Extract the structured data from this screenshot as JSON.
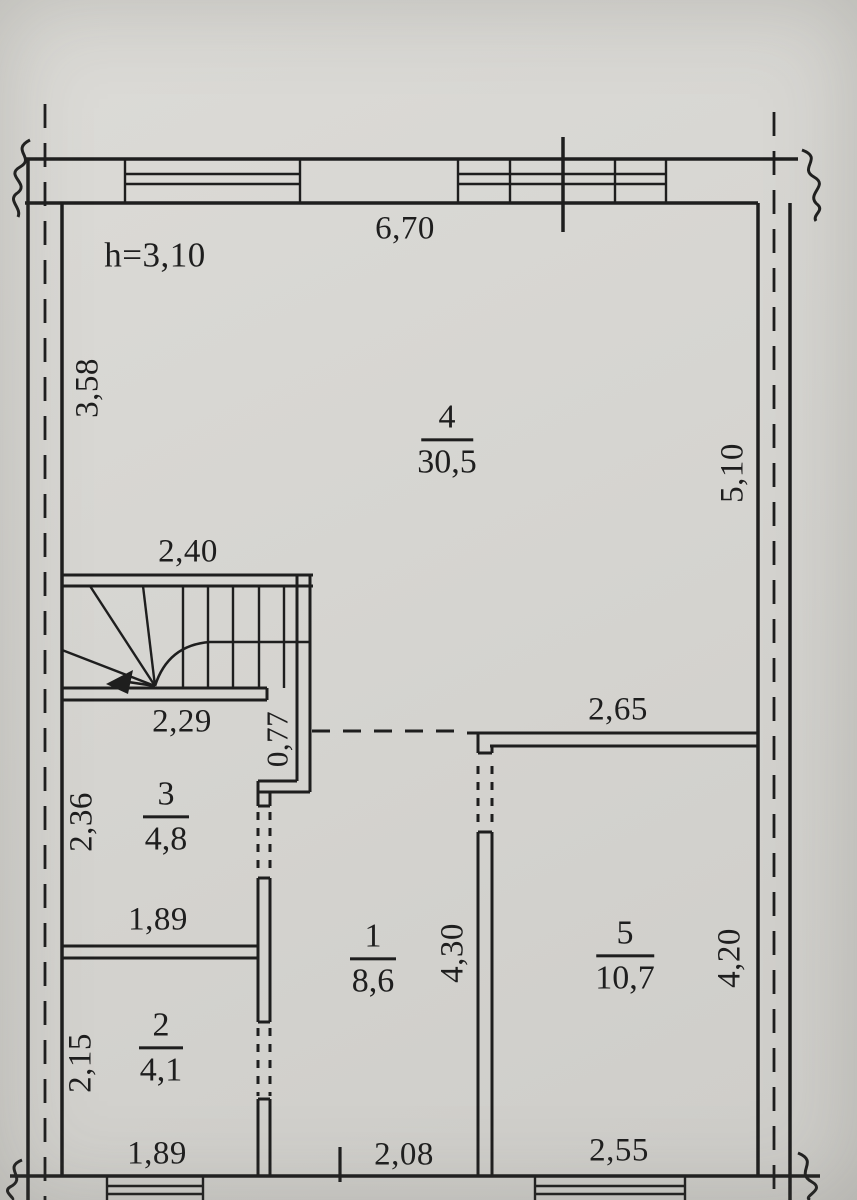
{
  "plan": {
    "ceiling_height_label": "h=3,10",
    "rooms": [
      {
        "number": "4",
        "area": "30,5"
      },
      {
        "number": "3",
        "area": "4,8"
      },
      {
        "number": "1",
        "area": "8,6"
      },
      {
        "number": "5",
        "area": "10,7"
      },
      {
        "number": "2",
        "area": "4,1"
      }
    ],
    "dimensions": {
      "top_wall": "6,70",
      "left_upper": "3,58",
      "right_upper": "5,10",
      "stairs_width": "2,40",
      "room3_width": "2,29",
      "wall_offset": "0,77",
      "room5_width_top": "2,65",
      "room3_height": "2,36",
      "room2_width_top": "1,89",
      "room1_height": "4,30",
      "room5_height": "4,20",
      "room2_height": "2,15",
      "bottom_left": "1,89",
      "bottom_middle": "2,08",
      "bottom_right": "2,55"
    },
    "colors": {
      "paper": "#d6d5d1",
      "ink": "#1e1e1e"
    }
  }
}
